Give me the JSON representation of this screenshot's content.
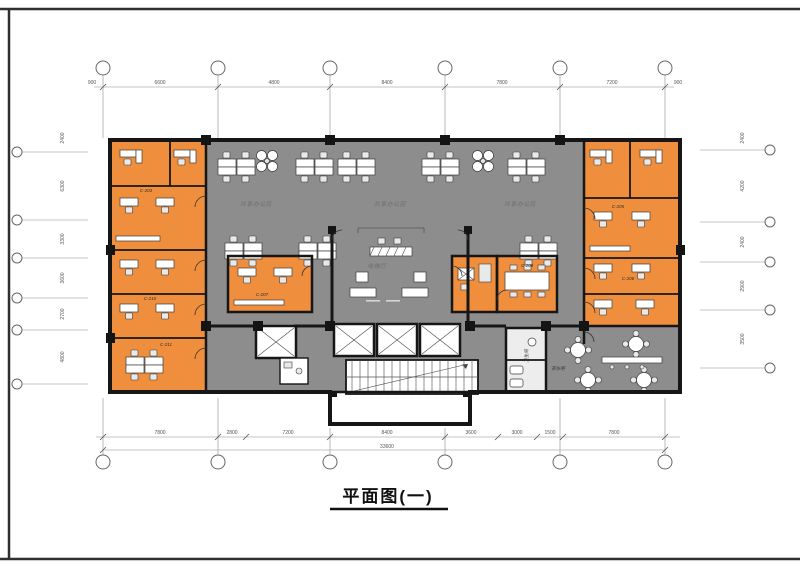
{
  "title": "平面图(一)",
  "labels": {
    "shared_office": "共享办公区",
    "elevator_hall": "电梯厅",
    "pantry": "茶水吧",
    "wc": "卫生间"
  },
  "rooms": {
    "left_r2": "C-203",
    "left_r4": "C-210",
    "left_r5": "C-211",
    "right_r2": "C-205",
    "right_r3": "C-206",
    "meeting": "C-207",
    "conference": "C-208"
  },
  "dims": {
    "top": [
      "900",
      "6600",
      "4800",
      "8400",
      "7800",
      "7200",
      "900"
    ],
    "bottom": [
      "7800",
      "2800",
      "7200",
      "8400",
      "3600",
      "3000",
      "1500",
      "7800"
    ],
    "total": "33600",
    "left": [
      "2400",
      "6300",
      "3300",
      "3600",
      "2700",
      "4800"
    ],
    "right": [
      "2400",
      "4200",
      "2400",
      "2900",
      "3500"
    ]
  },
  "colors": {
    "room_fill": "#EF8E3C",
    "floor_fill": "#8D8D8D",
    "wall": "#161616",
    "background": "#FFFFFF"
  }
}
